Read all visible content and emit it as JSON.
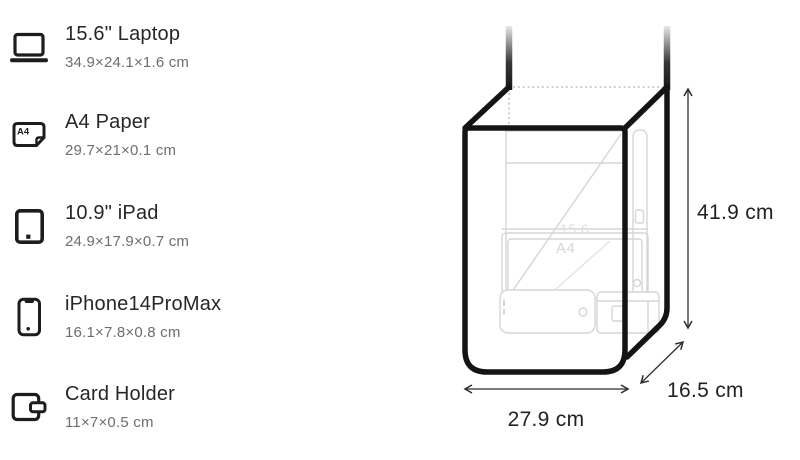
{
  "items": [
    {
      "icon": "laptop-icon",
      "name": "15.6\" Laptop",
      "dimensions": "34.9×24.1×1.6 cm"
    },
    {
      "icon": "a4-paper-icon",
      "name": "A4 Paper",
      "dimensions": "29.7×21×0.1 cm"
    },
    {
      "icon": "ipad-icon",
      "name": "10.9\" iPad",
      "dimensions": "24.9×17.9×0.7 cm"
    },
    {
      "icon": "iphone-icon",
      "name": "iPhone14ProMax",
      "dimensions": "16.1×7.8×0.8 cm"
    },
    {
      "icon": "card-holder-icon",
      "name": "Card Holder",
      "dimensions": "11×7×0.5 cm"
    }
  ],
  "icon_labels": {
    "a4_badge": "A4"
  },
  "diagram": {
    "type": "bag-capacity-dimensions",
    "height_label": "41.9 cm",
    "width_label": "27.9 cm",
    "depth_label": "16.5 cm",
    "ghost_item_labels": {
      "laptop": "15.6",
      "a4_paper": "A4"
    }
  },
  "colors": {
    "background": "#ffffff",
    "bag_outline": "#141414",
    "title_text": "#272727",
    "secondary_text": "#6e6e6e",
    "ghost_outline": "#d6d6d6",
    "dimension_lines": "#2e2e2e"
  }
}
